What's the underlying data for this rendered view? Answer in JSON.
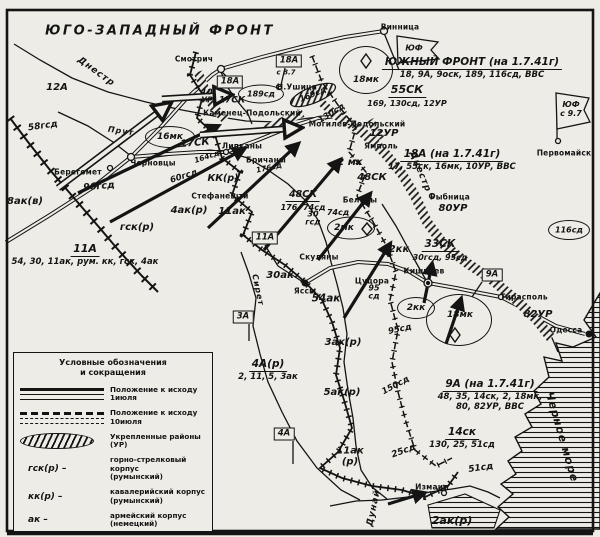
{
  "map_title": "ЮГО-ЗАПАДНЫЙ ФРОНТ",
  "headings": [
    {
      "title": "ЮЖНЫЙ ФРОНТ (на 1.7.41г)",
      "sub": "18, 9А, 9оск, 189, 116сд, ВВС",
      "x": 472,
      "y": 50,
      "tfs": 10.5,
      "sfs": 8.5
    },
    {
      "title": "55СК",
      "sub": "169, 130сд, 12УР",
      "x": 407,
      "y": 78,
      "tfs": 11,
      "sfs": 8
    },
    {
      "title": "18А (на 1.7.41г)",
      "sub": "17, 55ск, 16мк, 10УР, ВВС",
      "x": 452,
      "y": 142,
      "tfs": 10.5,
      "sfs": 8.5
    },
    {
      "title": "11А",
      "sub": "54, 30, 11ак, рум. кк, гск, 4ак",
      "x": 85,
      "y": 237,
      "tfs": 11,
      "sfs": 8.5
    },
    {
      "title": "48СК",
      "sub": "176, 74сд",
      "x": 303,
      "y": 182,
      "tfs": 9.5,
      "sfs": 8
    },
    {
      "title": "33СК",
      "sub": "30гсд, 95сд",
      "x": 440,
      "y": 232,
      "tfs": 10.5,
      "sfs": 8
    },
    {
      "title": "4А(р)",
      "sub": "2, 11, 5, 3ак",
      "x": 268,
      "y": 352,
      "tfs": 10.5,
      "sfs": 8.5
    },
    {
      "title": "9А (на 1.7.41г)",
      "sub": "48, 35, 14ск, 2, 18мк,\n80, 82УР, ВВС",
      "x": 490,
      "y": 372,
      "tfs": 10.5,
      "sfs": 8.5
    },
    {
      "title": "14ск",
      "sub": "130, 25, 51сд",
      "x": 462,
      "y": 420,
      "tfs": 10.5,
      "sfs": 8.5
    }
  ],
  "unit_labels": [
    {
      "t": "12А",
      "x": 57,
      "y": 88,
      "fs": 10
    },
    {
      "t": "58гсд",
      "x": 43,
      "y": 127,
      "fs": 9,
      "rot": -8
    },
    {
      "t": "8ак(в)",
      "x": 25,
      "y": 202,
      "fs": 10
    },
    {
      "t": "96гсд",
      "x": 99,
      "y": 187,
      "fs": 9.5,
      "rot": -5
    },
    {
      "t": "гск(р)",
      "x": 137,
      "y": 228,
      "fs": 10
    },
    {
      "t": "60гсд",
      "x": 184,
      "y": 177,
      "fs": 8.5,
      "rot": -18
    },
    {
      "t": "164сд",
      "x": 207,
      "y": 157,
      "fs": 7.5,
      "rot": -18
    },
    {
      "t": "КК(р)",
      "x": 223,
      "y": 179,
      "fs": 9.5
    },
    {
      "t": "4ак(р)",
      "x": 189,
      "y": 211,
      "fs": 10
    },
    {
      "t": "11ак",
      "x": 232,
      "y": 212,
      "fs": 10
    },
    {
      "t": "30ак",
      "x": 280,
      "y": 276,
      "fs": 10
    },
    {
      "t": "54ак",
      "x": 326,
      "y": 299,
      "fs": 10.5
    },
    {
      "t": "10\nУР",
      "x": 207,
      "y": 97,
      "fs": 8
    },
    {
      "t": "17СК",
      "x": 232,
      "y": 101,
      "fs": 9
    },
    {
      "t": "17СК",
      "x": 195,
      "y": 144,
      "fs": 10,
      "rot": -5
    },
    {
      "t": "2 мк",
      "x": 350,
      "y": 163,
      "fs": 10
    },
    {
      "t": "48СК",
      "x": 372,
      "y": 178,
      "fs": 10
    },
    {
      "t": "2кк",
      "x": 399,
      "y": 250,
      "fs": 10
    },
    {
      "t": "30\nгсд",
      "x": 313,
      "y": 219,
      "fs": 8
    },
    {
      "t": "74сд",
      "x": 338,
      "y": 213,
      "fs": 8
    },
    {
      "t": "176сд",
      "x": 269,
      "y": 168,
      "fs": 7.5,
      "rot": -12
    },
    {
      "t": "169сд",
      "x": 313,
      "y": 95,
      "fs": 8,
      "rot": -22
    },
    {
      "t": "130сд",
      "x": 332,
      "y": 114,
      "fs": 8.5,
      "rot": -32
    },
    {
      "t": "95\nсд",
      "x": 374,
      "y": 293,
      "fs": 8
    },
    {
      "t": "95сд",
      "x": 400,
      "y": 330,
      "fs": 8.5,
      "rot": -12
    },
    {
      "t": "3ак(р)",
      "x": 343,
      "y": 343,
      "fs": 10
    },
    {
      "t": "5ак(р)",
      "x": 342,
      "y": 393,
      "fs": 10
    },
    {
      "t": "150сд",
      "x": 396,
      "y": 386,
      "fs": 8.5,
      "rot": -28
    },
    {
      "t": "11ак\n(р)",
      "x": 350,
      "y": 457,
      "fs": 10
    },
    {
      "t": "25сд",
      "x": 404,
      "y": 452,
      "fs": 9,
      "rot": -20
    },
    {
      "t": "51сд",
      "x": 481,
      "y": 469,
      "fs": 9,
      "rot": -8
    },
    {
      "t": "2ак(р)",
      "x": 452,
      "y": 521,
      "fs": 11
    },
    {
      "t": "80УР",
      "x": 453,
      "y": 209,
      "fs": 10
    },
    {
      "t": "12УР",
      "x": 384,
      "y": 134,
      "fs": 10
    },
    {
      "t": "82УР",
      "x": 538,
      "y": 315,
      "fs": 10
    },
    {
      "t": "с 8.7",
      "x": 286,
      "y": 73,
      "fs": 7
    }
  ],
  "towns": [
    {
      "name": "Смотрич",
      "x": 194,
      "y": 59
    },
    {
      "name": "Н.Ушица",
      "x": 297,
      "y": 87
    },
    {
      "name": "Каменец-Подольский",
      "x": 252,
      "y": 113
    },
    {
      "name": "Могилев-Подольский",
      "x": 357,
      "y": 124
    },
    {
      "name": "Ямполь",
      "x": 381,
      "y": 146
    },
    {
      "name": "Винница",
      "x": 400,
      "y": 27
    },
    {
      "name": "Черновцы",
      "x": 153,
      "y": 163
    },
    {
      "name": "Берегомет",
      "x": 78,
      "y": 172
    },
    {
      "name": "Липканы",
      "x": 242,
      "y": 146
    },
    {
      "name": "Бричаны",
      "x": 266,
      "y": 160
    },
    {
      "name": "Стефанешти",
      "x": 220,
      "y": 196
    },
    {
      "name": "Скуляны",
      "x": 319,
      "y": 257
    },
    {
      "name": "Яссы",
      "x": 305,
      "y": 291
    },
    {
      "name": "Цуцора",
      "x": 372,
      "y": 281
    },
    {
      "name": "Кишинев",
      "x": 424,
      "y": 271
    },
    {
      "name": "Бельцы",
      "x": 360,
      "y": 200
    },
    {
      "name": "Рыбница",
      "x": 450,
      "y": 197
    },
    {
      "name": "Тирасполь",
      "x": 524,
      "y": 297
    },
    {
      "name": "Одесса",
      "x": 566,
      "y": 330
    },
    {
      "name": "Первомайск",
      "x": 564,
      "y": 153
    },
    {
      "name": "Измаил",
      "x": 432,
      "y": 487
    }
  ],
  "rivers": [
    {
      "name": "Днестр",
      "x": 96,
      "y": 72,
      "rot": 36,
      "fs": 9
    },
    {
      "name": "Прут",
      "x": 121,
      "y": 131,
      "rot": 8,
      "fs": 8
    },
    {
      "name": "Сирет",
      "x": 258,
      "y": 290,
      "rot": 78,
      "fs": 8
    },
    {
      "name": "Днестр",
      "x": 420,
      "y": 172,
      "rot": 68,
      "fs": 9
    },
    {
      "name": "Дунай",
      "x": 374,
      "y": 508,
      "rot": -78,
      "fs": 9
    },
    {
      "name": "Черное море",
      "x": 562,
      "y": 437,
      "rot": 74,
      "fs": 11
    }
  ],
  "flags": {
    "boxes": [
      {
        "label": "18А",
        "x": 230,
        "y": 82
      },
      {
        "label": "18А",
        "x": 289,
        "y": 61
      },
      {
        "label": "11А",
        "x": 265,
        "y": 238
      },
      {
        "label": "3А",
        "x": 243,
        "y": 317
      },
      {
        "label": "9А",
        "x": 492,
        "y": 275
      },
      {
        "label": "4А",
        "x": 284,
        "y": 434
      }
    ],
    "pennants": [
      {
        "label": "ЮФ",
        "note": "",
        "x": 414,
        "y": 49
      },
      {
        "label": "ЮФ",
        "note": "с 9.7",
        "x": 571,
        "y": 110
      }
    ]
  },
  "ovals": [
    {
      "label": "16мк",
      "x": 170,
      "y": 137,
      "w": 48,
      "h": 20,
      "fs": 9
    },
    {
      "label": "18мк",
      "x": 366,
      "y": 70,
      "w": 52,
      "h": 46,
      "fs": 9,
      "lx": 366,
      "ly": 80
    },
    {
      "label": "189сд",
      "x": 261,
      "y": 94,
      "w": 44,
      "h": 17,
      "fs": 8
    },
    {
      "label": "116сд",
      "x": 569,
      "y": 230,
      "w": 40,
      "h": 18,
      "fs": 8
    },
    {
      "label": "2мк",
      "x": 351,
      "y": 228,
      "w": 46,
      "h": 21,
      "fs": 9,
      "lx": 344,
      "ly": 228
    },
    {
      "label": "2кк",
      "x": 416,
      "y": 308,
      "w": 36,
      "h": 20,
      "fs": 9
    },
    {
      "label": "18мк",
      "x": 459,
      "y": 320,
      "w": 64,
      "h": 50,
      "fs": 9,
      "lx": 460,
      "ly": 315
    }
  ],
  "legend": {
    "title_line1": "Условные обозначения",
    "title_line2": "и сокращения",
    "line_items": [
      {
        "symbol": "solid",
        "text": "Положение к исходу 1июля"
      },
      {
        "symbol": "dashed",
        "text": "Положение к исходу 10июля"
      },
      {
        "symbol": "ur",
        "text": "Укрепленные районы (УР)"
      }
    ],
    "abbr_items": [
      {
        "abbr": "гск(р) –",
        "text": "горно-стрелковый корпус",
        "text2": "(румынский)"
      },
      {
        "abbr": "кк(р) –",
        "text": "кавалерийский корпус",
        "text2": "(румынский)"
      },
      {
        "abbr": "ак   –",
        "text": "армейский корпус",
        "text2": "(немецкий)"
      }
    ]
  }
}
